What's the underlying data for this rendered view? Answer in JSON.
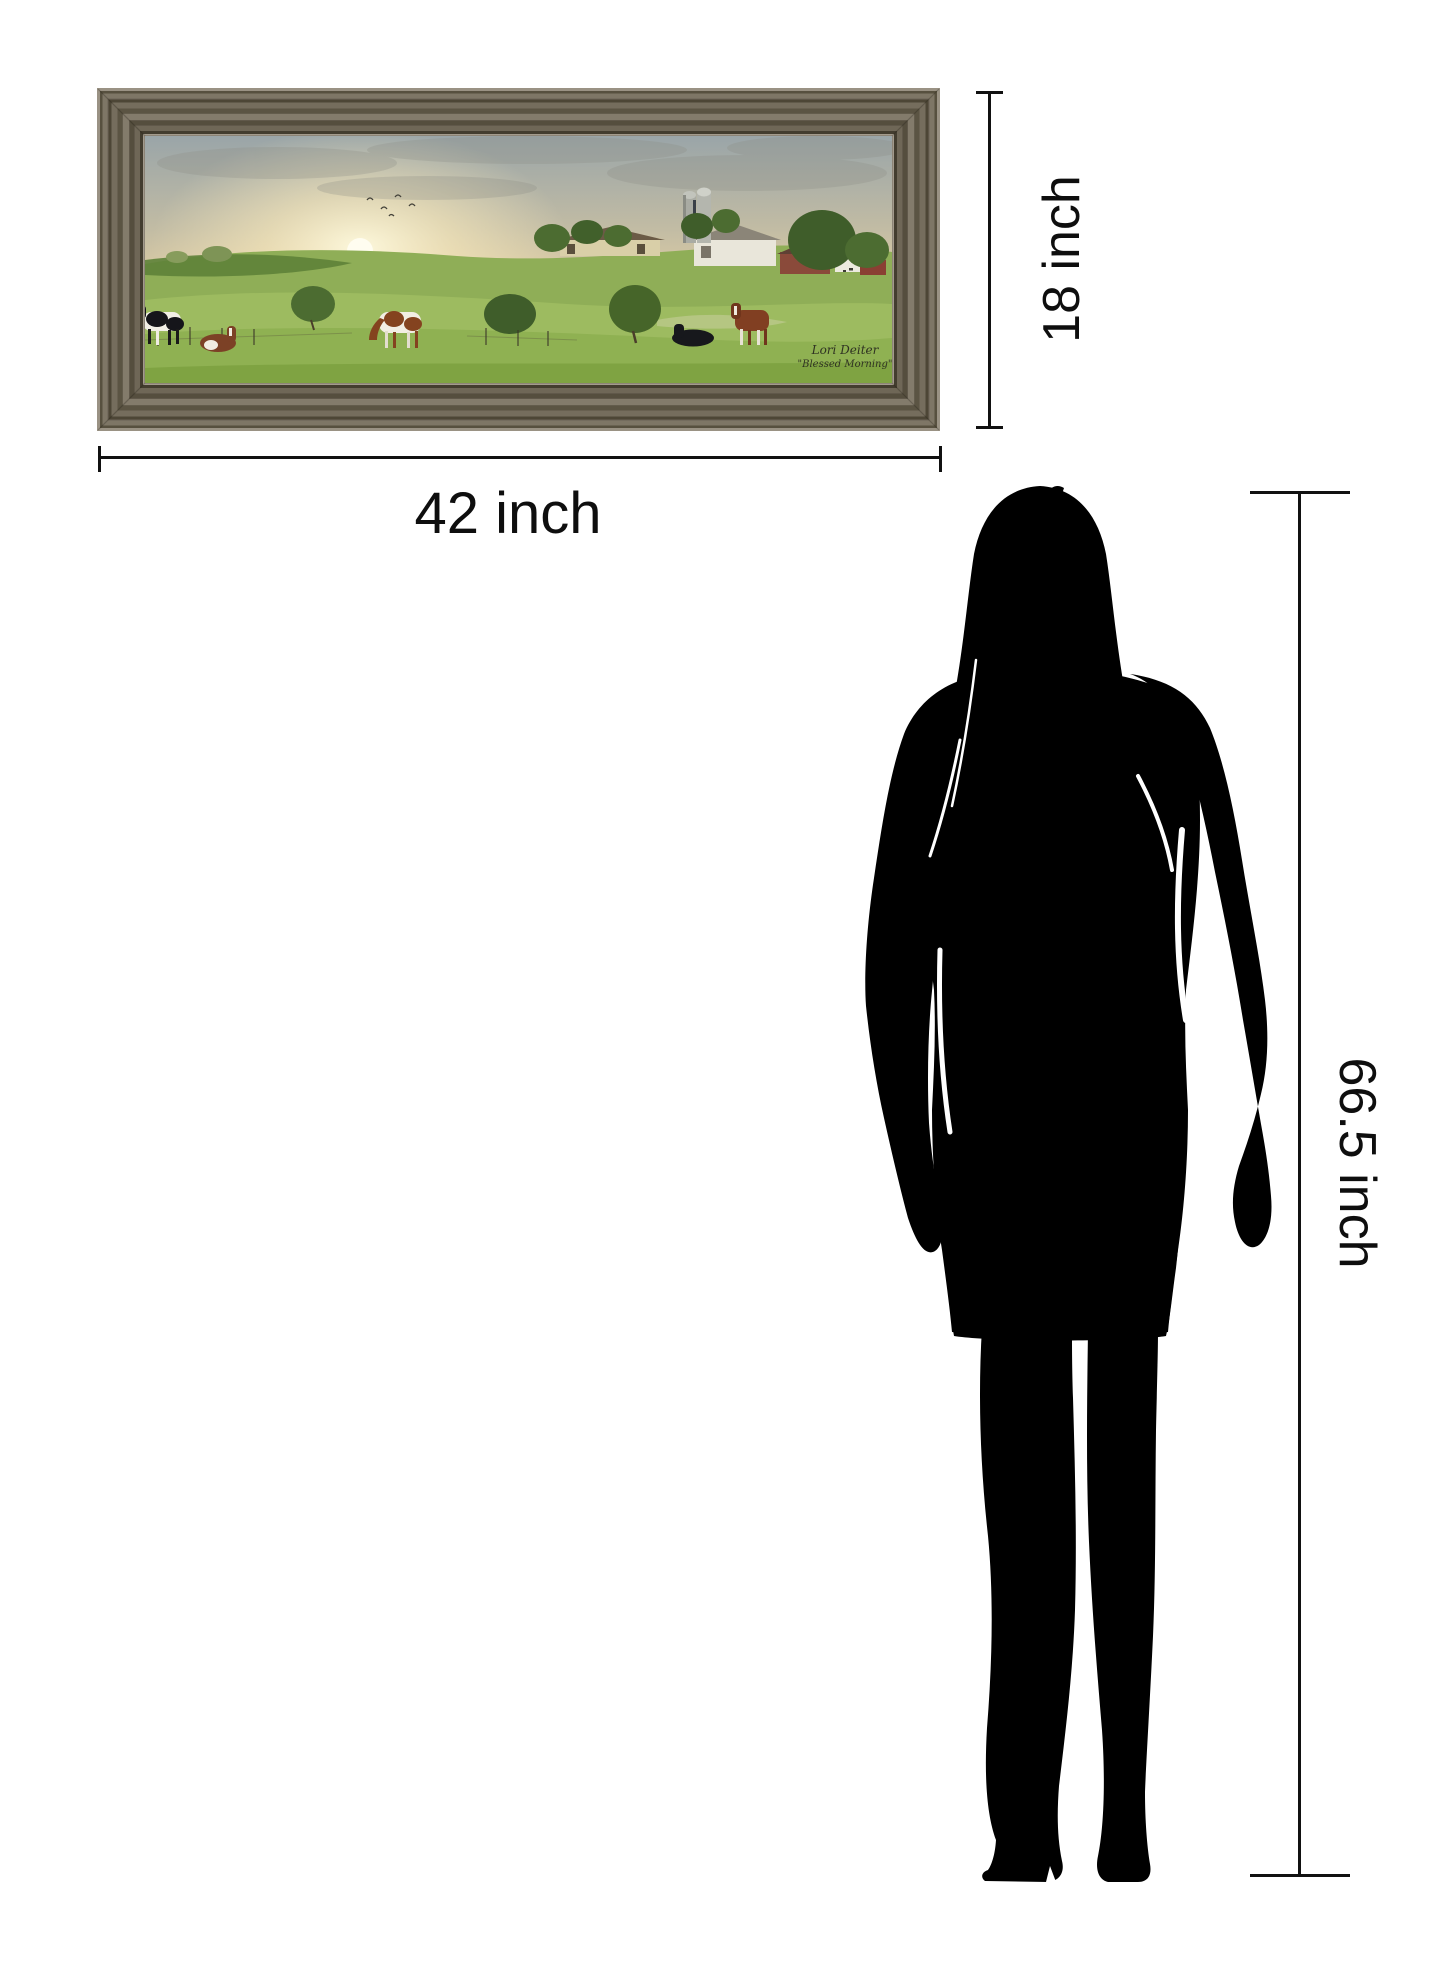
{
  "artwork": {
    "signature": {
      "artist": "Lori Deiter",
      "title": "\"Blessed Morning\""
    },
    "frame_color": "#6b6355",
    "scene_colors": {
      "sky_top": "#9aa5a8",
      "sky_warm": "#e8d3a6",
      "sun": "#fffdf0",
      "pasture": "#8fb152",
      "tree": "#3f5d2a",
      "barn_red": "#8a4a3a"
    }
  },
  "annotations": {
    "width": {
      "label": "42 inch"
    },
    "height": {
      "label": "18 inch"
    },
    "person_height": {
      "label": "66.5 inch"
    },
    "line_color": "#111111",
    "text_color": "#0e0e0e"
  },
  "silhouette": {
    "color": "#000000"
  }
}
